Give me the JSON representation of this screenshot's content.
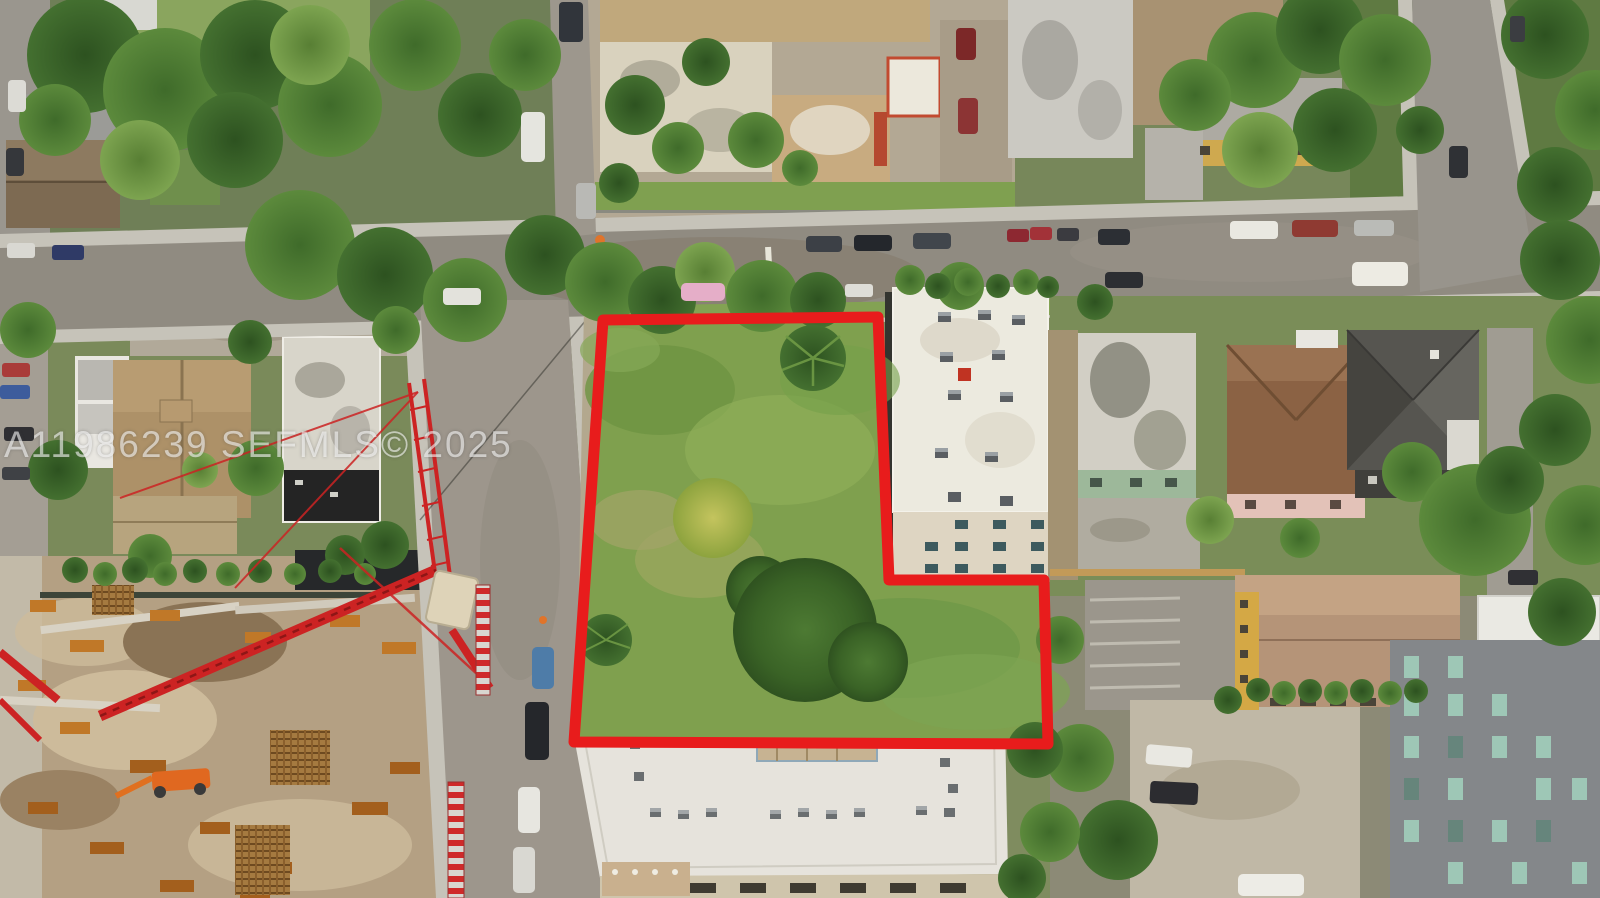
{
  "image": {
    "type": "aerial-drone-photo",
    "subject": "L-shaped vacant corner lot outlined in red in an urban Miami neighborhood"
  },
  "watermark": {
    "text": "A11986239 SEFMLS© 2025"
  },
  "colors": {
    "outline-red": "#e81c1c",
    "crane-red": "#cc2323",
    "lot-grass": "#7fa04e",
    "road-gray": "#908b81",
    "construction-dirt": "#b4a083",
    "watermark-white": "rgba(255,255,255,0.58)"
  },
  "scene": {
    "elements": [
      "vacant-lot",
      "red-boundary",
      "streets-intersection",
      "parked-cars",
      "construction-site",
      "tower-crane",
      "white-apartment-building",
      "bottom-rooftop-building",
      "neighborhood-houses",
      "trees-and-palms"
    ]
  }
}
